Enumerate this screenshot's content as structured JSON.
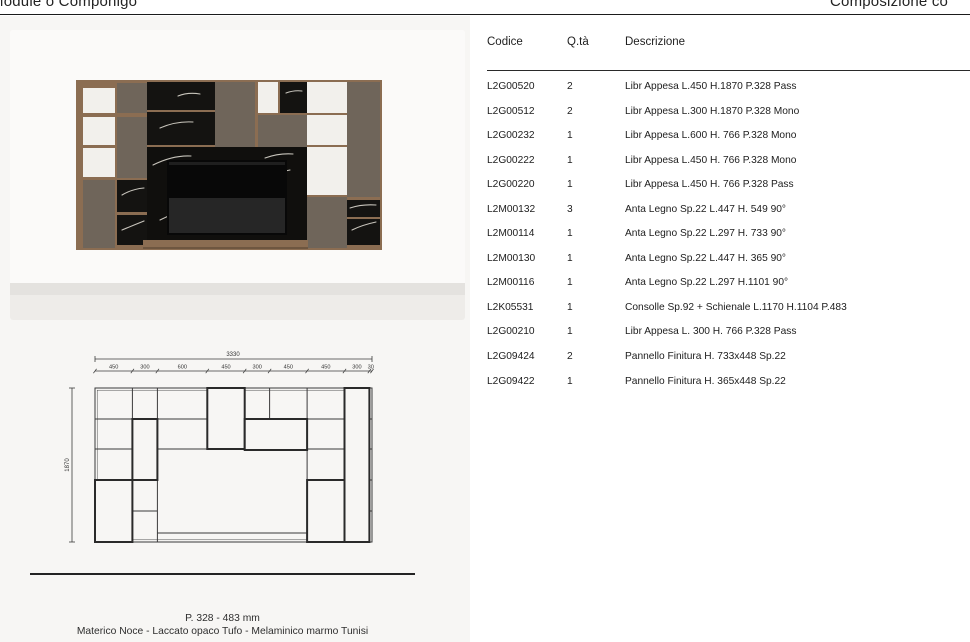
{
  "page_header": {
    "left_title": "Module o Componigo",
    "right_title": "Composizione co"
  },
  "table": {
    "columns": [
      "Codice",
      "Q.tà",
      "Descrizione"
    ],
    "rows": [
      {
        "code": "L2G00520",
        "qty": "2",
        "desc": "Libr Appesa L.450 H.1870 P.328 Pass"
      },
      {
        "code": "L2G00512",
        "qty": "2",
        "desc": "Libr Appesa L.300 H.1870 P.328 Mono"
      },
      {
        "code": "L2G00232",
        "qty": "1",
        "desc": "Libr Appesa L.600 H. 766 P.328 Mono"
      },
      {
        "code": "L2G00222",
        "qty": "1",
        "desc": "Libr Appesa L.450 H. 766 P.328 Mono"
      },
      {
        "code": "L2G00220",
        "qty": "1",
        "desc": "Libr Appesa L.450 H. 766 P.328 Pass"
      },
      {
        "code": "L2M00132",
        "qty": "3",
        "desc": "Anta Legno Sp.22 L.447 H. 549 90°"
      },
      {
        "code": "L2M00114",
        "qty": "1",
        "desc": "Anta Legno Sp.22 L.297 H. 733 90°"
      },
      {
        "code": "L2M00130",
        "qty": "1",
        "desc": "Anta Legno Sp.22 L.447 H. 365 90°"
      },
      {
        "code": "L2M00116",
        "qty": "1",
        "desc": "Anta Legno Sp.22 L.297 H.1101 90°"
      },
      {
        "code": "L2K05531",
        "qty": "1",
        "desc": "Consolle Sp.92 + Schienale L.1170 H.1104 P.483"
      },
      {
        "code": "L2G00210",
        "qty": "1",
        "desc": "Libr Appesa L. 300 H. 766 P.328 Pass"
      },
      {
        "code": "L2G09424",
        "qty": "2",
        "desc": "Pannello Finitura H. 733x448 Sp.22"
      },
      {
        "code": "L2G09422",
        "qty": "1",
        "desc": "Pannello Finitura H. 365x448 Sp.22"
      }
    ]
  },
  "drawing": {
    "overall_width": "3330",
    "overall_height": "1870",
    "segment_widths": [
      "450",
      "300",
      "600",
      "450",
      "300",
      "450",
      "450",
      "300",
      "30"
    ]
  },
  "caption": {
    "line1": "P. 328 - 483 mm",
    "line2": "Materico Noce - Laccato opaco Tufo - Melaminico marmo Tunisi"
  },
  "colors": {
    "wood": "#8b6d52",
    "taupe_lacquer": "#6f655a",
    "marble_black": "#141311",
    "panel_background": "#f7f6f4",
    "rule": "#1b1b1b"
  }
}
